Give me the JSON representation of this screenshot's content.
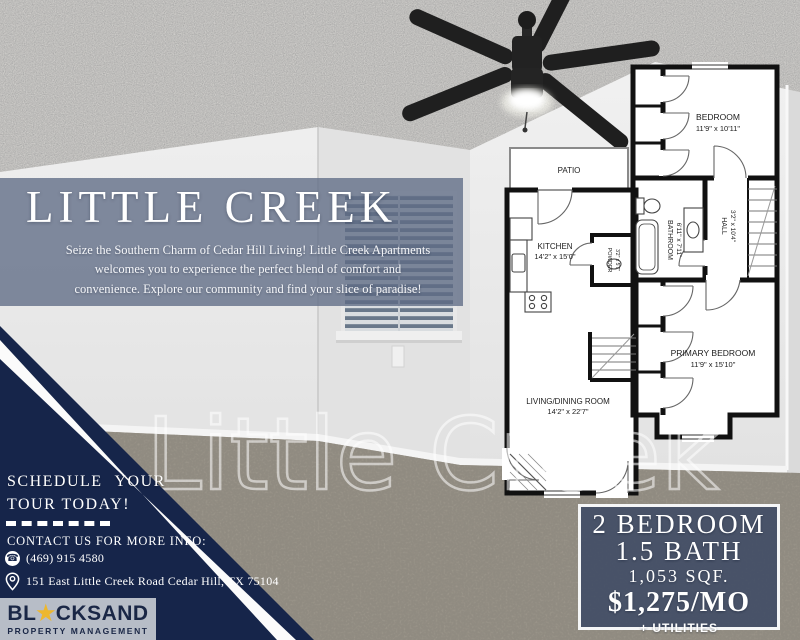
{
  "flyer": {
    "title": "LITTLE CREEK",
    "description_lines": [
      "Seize the Southern Charm of Cedar Hill Living! Little Creek Apartments",
      "welcomes you to experience the perfect blend of comfort and",
      "convenience. Explore our community and find your slice of paradise!"
    ],
    "watermark": "Little Creek"
  },
  "cta": {
    "line1": "SCHEDULE YOUR",
    "line2": "TOUR TODAY!"
  },
  "contact": {
    "heading": "CONTACT US FOR MORE INFO:",
    "phone": "(469) 915 4580",
    "address": "151 East Little Creek Road Cedar Hill, TX 75104"
  },
  "logo": {
    "prefix": "BL",
    "star": "★",
    "suffix": "CKSAND",
    "tagline": "PROPERTY MANAGEMENT"
  },
  "pricing": {
    "bedrooms": "2 BEDROOM",
    "bathrooms": "1.5 BATH",
    "area": "1,053 SQF.",
    "rent": "$1,275/MO",
    "note": "+ UTILITIES"
  },
  "floorplan": {
    "rooms": {
      "patio": {
        "name": "PATIO",
        "dims": ""
      },
      "kitchen": {
        "name": "KITCHEN",
        "dims": "14'2\" x 15'0\""
      },
      "powder": {
        "name": "POWDER",
        "dims": "3'2\" x 5'7\""
      },
      "living": {
        "name": "LIVING/DINING ROOM",
        "dims": "14'2\" x 22'7\""
      },
      "bedroom": {
        "name": "BEDROOM",
        "dims": "11'9\" x 10'11\""
      },
      "bathroom": {
        "name": "BATHROOM",
        "dims": "6'11\" x 7'11\""
      },
      "hall": {
        "name": "HALL",
        "dims": "3'2\" x 10'4\""
      },
      "primary": {
        "name": "PRIMARY BEDROOM",
        "dims": "11'9\" x 15'10\""
      }
    }
  },
  "icons": {
    "phone": "☎",
    "location": "map-pin-outline",
    "star": "star",
    "fan": "ceiling-fan"
  },
  "colors": {
    "navy": "#16254a",
    "band": "#5f6c85",
    "price_box": "#3a4763",
    "gold": "#edb72e",
    "logo_bg": "#b7bdc7",
    "carpet": "#a29b91"
  }
}
